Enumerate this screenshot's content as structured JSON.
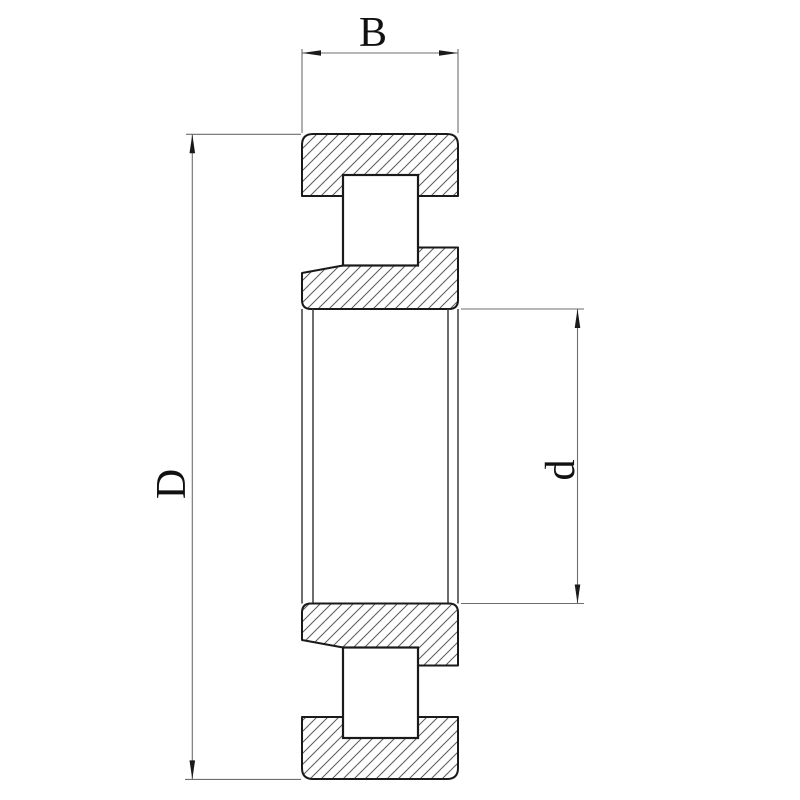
{
  "drawing": {
    "type": "bearing-cross-section-technical-drawing",
    "dimensions": {
      "width_label": "B",
      "outer_diameter_label": "D",
      "bore_diameter_label": "d"
    },
    "colors": {
      "background": "#ffffff",
      "outline": "#1a1a1a",
      "hatch_line": "#5a5a5a",
      "dimension_line": "#6e6e6e",
      "label_text": "#111111"
    }
  }
}
